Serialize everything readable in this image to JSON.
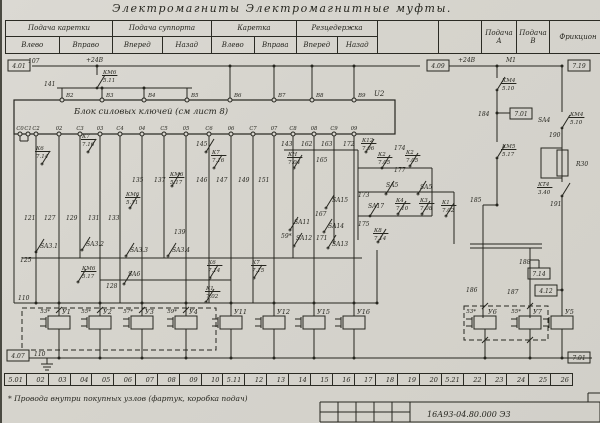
{
  "title": "Электромагниты   Электромагнитные   муфты.",
  "footnote": "* Провода  внутри  покупных  узлов (фартук, коробка  подач)",
  "doc_number": "16А93-04.80.000 Э3",
  "header": {
    "cells": [
      {
        "label": "Подача каретки",
        "subs": [
          "Влево",
          "Вправо"
        ],
        "w": 106
      },
      {
        "label": "Подача суппорта",
        "subs": [
          "Вперед",
          "Назад"
        ],
        "w": 98
      },
      {
        "label": "Каретка",
        "subs": [
          "Влево",
          "Вправа"
        ],
        "w": 84
      },
      {
        "label": "Резцедержка",
        "subs": [
          "Вперед",
          "Назад"
        ],
        "w": 80
      },
      {
        "label": "",
        "w": 60
      },
      {
        "label": "",
        "w": 42
      },
      {
        "label": "Подача\nА",
        "w": 34
      },
      {
        "label": "Подача\nВ",
        "w": 32
      },
      {
        "label": "Фрикцион",
        "w": 56
      }
    ]
  },
  "zones": [
    "5.01",
    "02",
    "03",
    "04",
    "05",
    "06",
    "07",
    "08",
    "09",
    "10",
    "5.11",
    "12",
    "13",
    "14",
    "15",
    "16",
    "17",
    "18",
    "19",
    "20",
    "5.21",
    "22",
    "23",
    "24",
    "25",
    "26"
  ],
  "schematic": {
    "ink": "#26261f",
    "block": {
      "label": "Блок   силовых   ключей    (см  лист 8)",
      "designator": "U2",
      "x": 12,
      "y": 100,
      "w": 381,
      "h": 34,
      "top_terminals": [
        {
          "t": "В2",
          "x": 60
        },
        {
          "t": "В3",
          "x": 100
        },
        {
          "t": "В4",
          "x": 142
        },
        {
          "t": "В5",
          "x": 185
        },
        {
          "t": "В6",
          "x": 228
        },
        {
          "t": "В7",
          "x": 272
        },
        {
          "t": "В8",
          "x": 310
        },
        {
          "t": "В9",
          "x": 352
        }
      ],
      "bottom_terminals": [
        {
          "t": "С0",
          "x": 18
        },
        {
          "t": "С1",
          "x": 26
        },
        {
          "t": "С2",
          "x": 34
        },
        {
          "t": "02",
          "x": 57
        },
        {
          "t": "С3",
          "x": 78
        },
        {
          "t": "03",
          "x": 98
        },
        {
          "t": "С4",
          "x": 118
        },
        {
          "t": "04",
          "x": 140
        },
        {
          "t": "С5",
          "x": 162
        },
        {
          "t": "05",
          "x": 184
        },
        {
          "t": "С6",
          "x": 207
        },
        {
          "t": "06",
          "x": 229
        },
        {
          "t": "С7",
          "x": 251
        },
        {
          "t": "07",
          "x": 272
        },
        {
          "t": "С8",
          "x": 291
        },
        {
          "t": "08",
          "x": 312
        },
        {
          "t": "С9",
          "x": 332
        },
        {
          "t": "09",
          "x": 352
        }
      ]
    },
    "ref_boxes": [
      {
        "t": "4.01",
        "x": 6,
        "y": 60
      },
      {
        "t": "4.09",
        "x": 425,
        "y": 60
      },
      {
        "t": "7.19",
        "x": 566,
        "y": 60
      },
      {
        "t": "7.01",
        "x": 508,
        "y": 108
      },
      {
        "t": "7.14",
        "x": 526,
        "y": 268
      },
      {
        "t": "4.12",
        "x": 533,
        "y": 285
      },
      {
        "t": "7.01",
        "x": 566,
        "y": 352
      },
      {
        "t": "4.07",
        "x": 5,
        "y": 350
      }
    ],
    "labels": [
      {
        "t": "107",
        "x": 26,
        "y": 63
      },
      {
        "t": "+24В",
        "x": 84,
        "y": 62
      },
      {
        "t": "141",
        "x": 42,
        "y": 86
      },
      {
        "t": "КМ6/5.11",
        "x": 101,
        "y": 74
      },
      {
        "t": "U2",
        "x": 372,
        "y": 96,
        "s": 7
      },
      {
        "t": "+24В",
        "x": 456,
        "y": 62
      },
      {
        "t": "М1",
        "x": 504,
        "y": 62
      },
      {
        "t": "КМ4/5.10",
        "x": 500,
        "y": 82
      },
      {
        "t": "184",
        "x": 476,
        "y": 116
      },
      {
        "t": "КМ5/5.17",
        "x": 500,
        "y": 148
      },
      {
        "t": "SA4",
        "x": 536,
        "y": 122
      },
      {
        "t": "КМ4/5.10",
        "x": 568,
        "y": 116
      },
      {
        "t": "190",
        "x": 547,
        "y": 137
      },
      {
        "t": "R30",
        "x": 574,
        "y": 166
      },
      {
        "t": "КТ4/3.40",
        "x": 536,
        "y": 186
      },
      {
        "t": "191",
        "x": 548,
        "y": 206
      },
      {
        "t": "К6/7.14",
        "x": 34,
        "y": 150
      },
      {
        "t": "К7/7.16",
        "x": 80,
        "y": 138
      },
      {
        "t": "145",
        "x": 194,
        "y": 146
      },
      {
        "t": "К7/7.16",
        "x": 210,
        "y": 154
      },
      {
        "t": "135",
        "x": 130,
        "y": 182
      },
      {
        "t": "137",
        "x": 152,
        "y": 182
      },
      {
        "t": "КМ6/5.17",
        "x": 168,
        "y": 176
      },
      {
        "t": "146",
        "x": 194,
        "y": 182
      },
      {
        "t": "147",
        "x": 214,
        "y": 182
      },
      {
        "t": "149",
        "x": 236,
        "y": 182
      },
      {
        "t": "151",
        "x": 256,
        "y": 182
      },
      {
        "t": "КМ6/5.11",
        "x": 124,
        "y": 196
      },
      {
        "t": "121",
        "x": 22,
        "y": 220
      },
      {
        "t": "127",
        "x": 42,
        "y": 220
      },
      {
        "t": "129",
        "x": 64,
        "y": 220
      },
      {
        "t": "131",
        "x": 86,
        "y": 220
      },
      {
        "t": "133",
        "x": 106,
        "y": 220
      },
      {
        "t": "139",
        "x": 172,
        "y": 234
      },
      {
        "t": "SA3.1",
        "x": 38,
        "y": 248
      },
      {
        "t": "SA3.2",
        "x": 84,
        "y": 246
      },
      {
        "t": "SA3.3",
        "x": 128,
        "y": 252
      },
      {
        "t": "SA3.4",
        "x": 170,
        "y": 252
      },
      {
        "t": "125",
        "x": 18,
        "y": 262
      },
      {
        "t": "КМ6/5.17",
        "x": 80,
        "y": 270
      },
      {
        "t": "SA6",
        "x": 126,
        "y": 276
      },
      {
        "t": "128",
        "x": 104,
        "y": 288
      },
      {
        "t": "К6/7.14",
        "x": 206,
        "y": 264
      },
      {
        "t": "К1/7.02",
        "x": 204,
        "y": 290
      },
      {
        "t": "К7/7.15",
        "x": 250,
        "y": 264
      },
      {
        "t": "SA11",
        "x": 292,
        "y": 224
      },
      {
        "t": "59*",
        "x": 279,
        "y": 238
      },
      {
        "t": "SA12",
        "x": 294,
        "y": 240
      },
      {
        "t": "167",
        "x": 313,
        "y": 216
      },
      {
        "t": "SA15",
        "x": 330,
        "y": 202
      },
      {
        "t": "SA14",
        "x": 326,
        "y": 228
      },
      {
        "t": "171",
        "x": 314,
        "y": 240
      },
      {
        "t": "SA13",
        "x": 330,
        "y": 246
      },
      {
        "t": "143",
        "x": 279,
        "y": 146
      },
      {
        "t": "162",
        "x": 299,
        "y": 146
      },
      {
        "t": "163",
        "x": 319,
        "y": 146
      },
      {
        "t": "172",
        "x": 341,
        "y": 146
      },
      {
        "t": "К12/7.06",
        "x": 360,
        "y": 142
      },
      {
        "t": "174",
        "x": 392,
        "y": 150
      },
      {
        "t": "КН/7.04",
        "x": 286,
        "y": 156
      },
      {
        "t": "165",
        "x": 314,
        "y": 162
      },
      {
        "t": "К2/7.05",
        "x": 376,
        "y": 156
      },
      {
        "t": "К2/7.05",
        "x": 404,
        "y": 154
      },
      {
        "t": "177",
        "x": 392,
        "y": 172
      },
      {
        "t": "SA5",
        "x": 384,
        "y": 187
      },
      {
        "t": "SA5",
        "x": 418,
        "y": 189
      },
      {
        "t": "173",
        "x": 356,
        "y": 197
      },
      {
        "t": "SA17",
        "x": 366,
        "y": 208
      },
      {
        "t": "К4/7.10",
        "x": 394,
        "y": 202
      },
      {
        "t": "К3/7.08",
        "x": 418,
        "y": 202
      },
      {
        "t": "К1/7.02",
        "x": 440,
        "y": 204
      },
      {
        "t": "175",
        "x": 356,
        "y": 226
      },
      {
        "t": "К8/7.14",
        "x": 372,
        "y": 232
      },
      {
        "t": "185",
        "x": 468,
        "y": 202
      },
      {
        "t": "186",
        "x": 464,
        "y": 292
      },
      {
        "t": "187",
        "x": 505,
        "y": 294
      },
      {
        "t": "188",
        "x": 517,
        "y": 264
      },
      {
        "t": "110",
        "x": 16,
        "y": 300
      },
      {
        "t": "110",
        "x": 32,
        "y": 356
      },
      {
        "t": "16А93-04.80.000 Э3",
        "x": 425,
        "y": 417,
        "s": 8
      }
    ],
    "lines": [
      [
        30,
        66,
        418,
        66
      ],
      [
        447,
        66,
        560,
        66
      ],
      [
        95,
        66,
        95,
        75
      ],
      [
        55,
        88,
        190,
        88
      ],
      [
        60,
        88,
        60,
        100
      ],
      [
        100,
        88,
        100,
        100
      ],
      [
        142,
        88,
        142,
        100
      ],
      [
        185,
        88,
        185,
        100
      ],
      [
        228,
        66,
        228,
        100
      ],
      [
        272,
        66,
        272,
        100
      ],
      [
        310,
        66,
        310,
        100
      ],
      [
        352,
        66,
        352,
        100
      ],
      [
        34,
        134,
        34,
        303
      ],
      [
        57,
        134,
        57,
        303
      ],
      [
        78,
        134,
        78,
        258
      ],
      [
        98,
        134,
        98,
        303
      ],
      [
        118,
        134,
        118,
        303
      ],
      [
        140,
        134,
        140,
        303
      ],
      [
        162,
        134,
        162,
        258
      ],
      [
        184,
        134,
        184,
        303
      ],
      [
        207,
        134,
        207,
        303
      ],
      [
        229,
        134,
        229,
        303
      ],
      [
        251,
        134,
        251,
        303
      ],
      [
        272,
        134,
        272,
        303
      ],
      [
        291,
        134,
        291,
        258
      ],
      [
        312,
        134,
        312,
        303
      ],
      [
        332,
        134,
        332,
        244
      ],
      [
        352,
        134,
        352,
        303
      ],
      [
        18,
        134,
        18,
        141
      ],
      [
        26,
        134,
        26,
        141
      ],
      [
        18,
        141,
        26,
        141
      ],
      [
        12,
        134,
        12,
        303
      ],
      [
        20,
        258,
        360,
        258
      ],
      [
        98,
        280,
        229,
        280
      ],
      [
        12,
        303,
        375,
        303
      ],
      [
        375,
        250,
        375,
        303
      ],
      [
        27,
        358,
        590,
        358
      ],
      [
        495,
        66,
        495,
        78
      ],
      [
        495,
        90,
        495,
        142
      ],
      [
        495,
        158,
        495,
        205
      ],
      [
        495,
        113,
        508,
        113
      ],
      [
        481,
        205,
        495,
        205
      ],
      [
        481,
        205,
        481,
        318
      ],
      [
        468,
        244,
        540,
        244
      ],
      [
        468,
        248,
        540,
        248
      ],
      [
        528,
        248,
        528,
        318
      ],
      [
        528,
        260,
        537,
        260
      ],
      [
        537,
        260,
        537,
        268
      ],
      [
        555,
        290,
        560,
        290
      ],
      [
        560,
        66,
        560,
        112
      ],
      [
        560,
        128,
        560,
        148
      ],
      [
        560,
        178,
        560,
        182
      ],
      [
        560,
        196,
        560,
        316
      ],
      [
        282,
        150,
        356,
        150
      ],
      [
        356,
        150,
        356,
        240
      ],
      [
        356,
        168,
        430,
        168
      ],
      [
        356,
        192,
        452,
        192
      ],
      [
        356,
        216,
        430,
        216
      ],
      [
        430,
        168,
        430,
        216
      ],
      [
        452,
        192,
        452,
        244
      ],
      [
        45,
        358,
        45,
        364
      ],
      [
        39,
        364,
        51,
        364
      ],
      [
        41,
        367,
        49,
        367
      ],
      [
        43,
        370,
        47,
        370
      ],
      [
        318,
        402,
        598,
        402
      ],
      [
        318,
        402,
        318,
        422
      ],
      [
        336,
        402,
        336,
        422
      ],
      [
        354,
        402,
        354,
        422
      ],
      [
        372,
        402,
        372,
        422
      ],
      [
        390,
        402,
        390,
        422
      ],
      [
        408,
        402,
        408,
        422
      ],
      [
        318,
        412,
        408,
        412
      ],
      [
        318,
        422,
        598,
        422
      ],
      [
        598,
        402,
        598,
        422
      ],
      [
        586,
        393,
        598,
        393
      ],
      [
        586,
        393,
        586,
        402
      ]
    ],
    "rects": [
      {
        "x": 555,
        "y": 150,
        "w": 11,
        "h": 26
      },
      {
        "x": 539,
        "y": 148,
        "w": 21,
        "h": 30
      }
    ],
    "dashed_boxes": [
      {
        "x": 20,
        "y": 308,
        "w": 194,
        "h": 42
      },
      {
        "x": 462,
        "y": 306,
        "w": 84,
        "h": 34
      }
    ],
    "switches": [
      [
        95,
        88
      ],
      [
        34,
        252
      ],
      [
        80,
        250
      ],
      [
        124,
        256
      ],
      [
        166,
        256
      ],
      [
        76,
        282
      ],
      [
        122,
        284
      ],
      [
        208,
        278
      ],
      [
        204,
        302
      ],
      [
        252,
        278
      ],
      [
        288,
        230
      ],
      [
        292,
        246
      ],
      [
        324,
        208
      ],
      [
        322,
        232
      ],
      [
        326,
        248
      ],
      [
        384,
        194
      ],
      [
        416,
        194
      ],
      [
        368,
        216
      ],
      [
        396,
        214
      ],
      [
        420,
        214
      ],
      [
        444,
        216
      ],
      [
        376,
        242
      ],
      [
        380,
        168
      ],
      [
        408,
        166
      ],
      [
        292,
        168
      ],
      [
        364,
        152
      ],
      [
        212,
        168
      ],
      [
        170,
        186
      ],
      [
        128,
        208
      ],
      [
        40,
        164
      ],
      [
        86,
        152
      ],
      [
        204,
        152
      ],
      [
        495,
        90
      ],
      [
        495,
        158
      ],
      [
        560,
        128
      ],
      [
        560,
        196
      ]
    ],
    "slashes": [
      [
        57,
        310
      ],
      [
        98,
        310
      ],
      [
        140,
        310
      ],
      [
        184,
        310
      ],
      [
        483,
        306
      ],
      [
        528,
        306
      ],
      [
        483,
        340
      ],
      [
        528,
        340
      ]
    ],
    "dots": [
      [
        95,
        66
      ],
      [
        228,
        66
      ],
      [
        272,
        66
      ],
      [
        310,
        66
      ],
      [
        352,
        66
      ],
      [
        495,
        66
      ],
      [
        560,
        66
      ],
      [
        100,
        88
      ],
      [
        142,
        88
      ],
      [
        495,
        113
      ],
      [
        495,
        205
      ],
      [
        560,
        290
      ],
      [
        34,
        303
      ],
      [
        57,
        303
      ],
      [
        98,
        303
      ],
      [
        140,
        303
      ],
      [
        184,
        303
      ],
      [
        229,
        303
      ],
      [
        272,
        303
      ],
      [
        312,
        303
      ],
      [
        352,
        303
      ],
      [
        375,
        303
      ],
      [
        57,
        358
      ],
      [
        98,
        358
      ],
      [
        140,
        358
      ],
      [
        184,
        358
      ],
      [
        229,
        358
      ],
      [
        272,
        358
      ],
      [
        312,
        358
      ],
      [
        352,
        358
      ],
      [
        483,
        358
      ],
      [
        528,
        358
      ],
      [
        560,
        358
      ]
    ],
    "coils": [
      {
        "name": "У1",
        "star": "53*",
        "x": 57,
        "top": 1
      },
      {
        "name": "У2",
        "star": "55*",
        "x": 98,
        "top": 1
      },
      {
        "name": "У3",
        "star": "57*",
        "x": 140,
        "top": 1
      },
      {
        "name": "У4",
        "star": "59*",
        "x": 184,
        "top": 1
      },
      {
        "name": "У11",
        "x": 229,
        "top": 1
      },
      {
        "name": "У12",
        "x": 272,
        "top": 1
      },
      {
        "name": "У15",
        "x": 312,
        "top": 1
      },
      {
        "name": "У16",
        "x": 352,
        "top": 1
      },
      {
        "name": "У6",
        "star": "53*",
        "x": 483,
        "top": 0
      },
      {
        "name": "У7",
        "star": "55*",
        "x": 528,
        "top": 0
      },
      {
        "name": "У5",
        "x": 560,
        "top": 0
      }
    ]
  }
}
